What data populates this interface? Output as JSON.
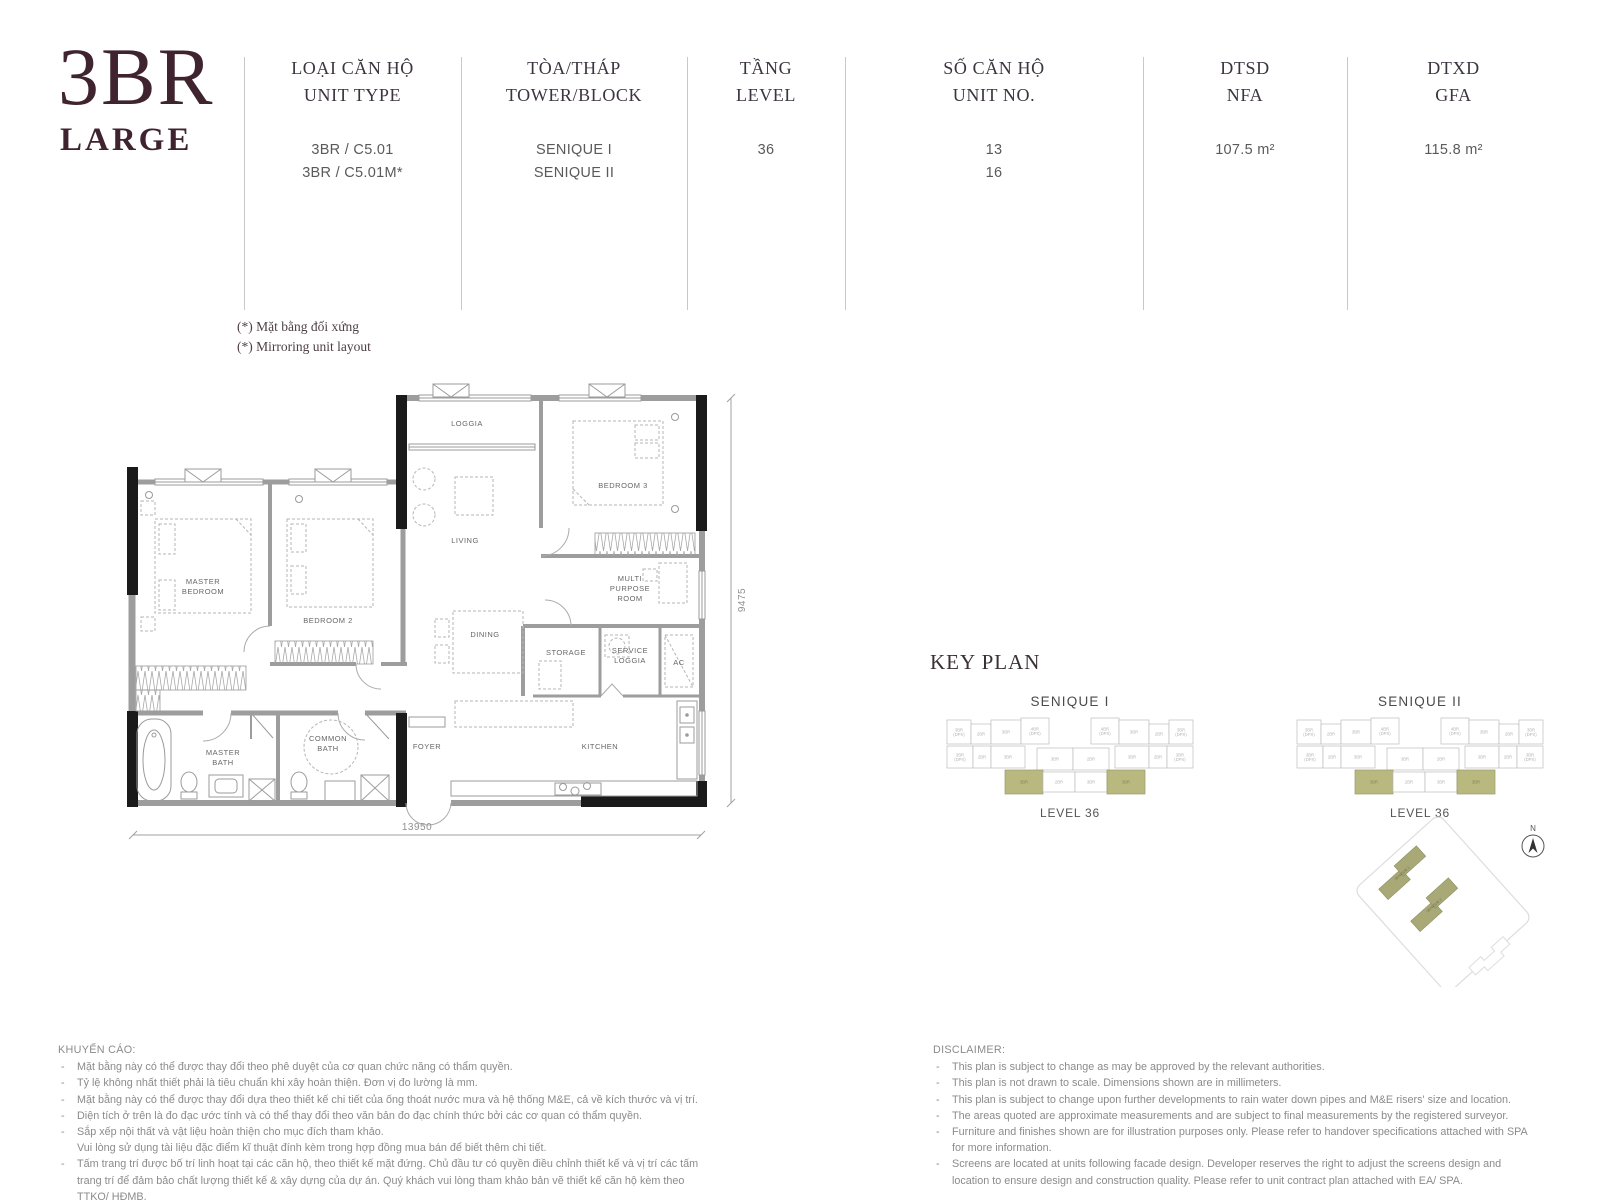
{
  "title": {
    "main": "3BR",
    "sub": "LARGE"
  },
  "spec_table": {
    "columns": [
      {
        "label_vn": "LOẠI CĂN HỘ",
        "label_en": "UNIT TYPE",
        "values": [
          "3BR / C5.01",
          "3BR / C5.01M*"
        ]
      },
      {
        "label_vn": "TÒA/THÁP",
        "label_en": "TOWER/BLOCK",
        "values": [
          "SENIQUE I",
          "SENIQUE II"
        ]
      },
      {
        "label_vn": "TẦNG",
        "label_en": "LEVEL",
        "values": [
          "36",
          ""
        ]
      },
      {
        "label_vn": "SỐ CĂN HỘ",
        "label_en": "UNIT NO.",
        "values": [
          "13",
          "16"
        ]
      },
      {
        "label_vn": "DTSD",
        "label_en": "NFA",
        "values": [
          "107.5 m²",
          ""
        ]
      },
      {
        "label_vn": "DTXD",
        "label_en": "GFA",
        "values": [
          "115.8 m²",
          ""
        ]
      }
    ],
    "note_vn": "(*) Mặt bằng đối xứng",
    "note_en": "(*) Mirroring unit layout"
  },
  "floorplan": {
    "rooms": {
      "master_bedroom": [
        "MASTER",
        "BEDROOM"
      ],
      "bedroom2": [
        "BEDROOM 2"
      ],
      "bedroom3": [
        "BEDROOM 3"
      ],
      "loggia": [
        "LOGGIA"
      ],
      "living": [
        "LIVING"
      ],
      "multi_purpose": [
        "MULTI",
        "PURPOSE",
        "ROOM"
      ],
      "dining": [
        "DINING"
      ],
      "storage": [
        "STORAGE"
      ],
      "service_loggia": [
        "SERVICE",
        "LOGGIA"
      ],
      "ac": [
        "AC"
      ],
      "kitchen": [
        "KITCHEN"
      ],
      "foyer": [
        "FOYER"
      ],
      "master_bath": [
        "MASTER",
        "BATH"
      ],
      "common_bath": [
        "COMMON",
        "BATH"
      ]
    },
    "dims": {
      "width": "13950",
      "height": "9475"
    }
  },
  "keyplan": {
    "heading": "KEY PLAN",
    "highlight_color": "#b9b97f",
    "towers": [
      {
        "name": "SENIQUE I",
        "level": "LEVEL 36"
      },
      {
        "name": "SENIQUE II",
        "level": "LEVEL 36"
      }
    ],
    "cells": [
      {
        "x": 2,
        "y": 6,
        "w": 24,
        "h": 24,
        "l": "3BR (DPX)"
      },
      {
        "x": 26,
        "y": 10,
        "w": 20,
        "h": 20,
        "l": "2BR"
      },
      {
        "x": 46,
        "y": 6,
        "w": 30,
        "h": 24,
        "l": "3BR"
      },
      {
        "x": 76,
        "y": 4,
        "w": 28,
        "h": 26,
        "l": "4BR (DPX)"
      },
      {
        "x": 146,
        "y": 4,
        "w": 28,
        "h": 26,
        "l": "4BR (DPX)"
      },
      {
        "x": 174,
        "y": 6,
        "w": 30,
        "h": 24,
        "l": "3BR"
      },
      {
        "x": 204,
        "y": 10,
        "w": 20,
        "h": 20,
        "l": "2BR"
      },
      {
        "x": 224,
        "y": 6,
        "w": 24,
        "h": 24,
        "l": "3BR (DPX)"
      },
      {
        "x": 2,
        "y": 32,
        "w": 26,
        "h": 22,
        "l": "3BR (DPX)"
      },
      {
        "x": 28,
        "y": 32,
        "w": 18,
        "h": 22,
        "l": "2BR"
      },
      {
        "x": 46,
        "y": 32,
        "w": 34,
        "h": 22,
        "l": "3BR"
      },
      {
        "x": 92,
        "y": 34,
        "w": 36,
        "h": 22,
        "l": "3BR"
      },
      {
        "x": 128,
        "y": 34,
        "w": 36,
        "h": 22,
        "l": "2BR"
      },
      {
        "x": 170,
        "y": 32,
        "w": 34,
        "h": 22,
        "l": "3BR"
      },
      {
        "x": 204,
        "y": 32,
        "w": 18,
        "h": 22,
        "l": "2BR"
      },
      {
        "x": 222,
        "y": 32,
        "w": 26,
        "h": 22,
        "l": "3BR (DPX)"
      },
      {
        "x": 60,
        "y": 56,
        "w": 38,
        "h": 24,
        "l": "3BR",
        "hl": true
      },
      {
        "x": 98,
        "y": 58,
        "w": 32,
        "h": 20,
        "l": "2BR"
      },
      {
        "x": 130,
        "y": 58,
        "w": 32,
        "h": 20,
        "l": "3BR"
      },
      {
        "x": 162,
        "y": 56,
        "w": 38,
        "h": 24,
        "l": "3BR",
        "hl": true
      }
    ],
    "site": {
      "buildings": [
        "SENIQUE 1",
        "SENIQUE 2"
      ],
      "north_label": "N"
    }
  },
  "disclaimer_vn": {
    "heading": "KHUYẾN CÁO:",
    "items": [
      {
        "d": "-",
        "t": "Mặt bằng này có thể được thay đổi theo phê duyệt của cơ quan chức năng có thẩm quyền."
      },
      {
        "d": "-",
        "t": "Tỷ lệ không nhất thiết phải là tiêu chuẩn khi xây hoàn thiện. Đơn vị đo lường là mm."
      },
      {
        "d": "-",
        "t": "Mặt bằng này có thể được thay đổi dựa theo thiết kế chi tiết của ống thoát nước mưa và hệ thống M&E, cả về kích thước và vị trí."
      },
      {
        "d": "-",
        "t": "Diện tích ở trên là đo đạc ước tính và có thể thay đổi theo văn bản đo đạc chính thức bởi các cơ quan có thẩm quyền."
      },
      {
        "d": "-",
        "t": "Sắp xếp nội thất và vật liệu hoàn thiện cho mục đích tham khảo."
      },
      {
        "d": "",
        "t": "Vui lòng sử dụng tài liệu đặc điểm kĩ thuật đính kèm trong hợp đồng mua bán để biết thêm chi tiết."
      },
      {
        "d": "-",
        "t": "Tấm trang trí được bố trí linh hoạt tại các căn hộ, theo thiết kế mặt đứng. Chủ đầu tư có quyền điều chỉnh thiết kế và vị trí các tấm trang trí để đảm bảo chất lượng thiết kế & xây dựng của dự án. Quý khách vui lòng tham khảo bản vẽ thiết kế căn hộ kèm theo TTKQ/ HĐMB."
      }
    ]
  },
  "disclaimer_en": {
    "heading": "DISCLAIMER:",
    "items": [
      {
        "d": "-",
        "t": "This plan is subject to change as may be approved by the relevant authorities."
      },
      {
        "d": "-",
        "t": "This plan is not drawn to scale. Dimensions shown are in millimeters."
      },
      {
        "d": "-",
        "t": "This plan is subject to change upon further developments to rain water down pipes and M&E risers' size and location."
      },
      {
        "d": "-",
        "t": "The areas quoted are approximate measurements and are subject to final measurements by the registered surveyor."
      },
      {
        "d": "-",
        "t": "Furniture and finishes shown are for illustration purposes only. Please refer to handover specifications attached with SPA for more information."
      },
      {
        "d": "-",
        "t": "Screens are located at units following facade design. Developer reserves the right to adjust the screens design and location to ensure design and construction quality. Please refer to unit contract plan attached with EA/ SPA."
      }
    ]
  }
}
